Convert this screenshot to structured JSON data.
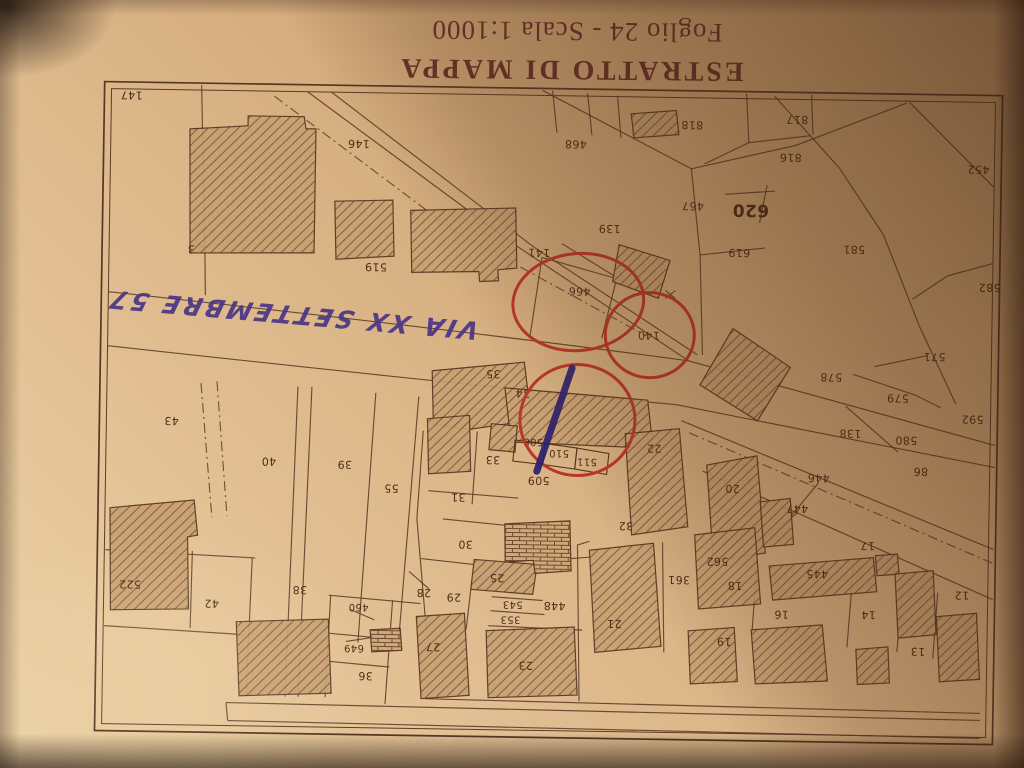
{
  "document": {
    "title": "ESTRATTO DI MAPPA",
    "subtitle": "Foglio 24 - Scala 1:1000",
    "orientation": "photo rotated 180 degrees"
  },
  "map": {
    "street_label": "VIA XX SETTEMBRE 57",
    "colors": {
      "paper": "#ddb98c",
      "ink": "#5a3b26",
      "title_ink": "#69302a",
      "red_pen": "#bc3628",
      "blue_pen": "#2b1f6e",
      "violet_pen": "#4a3585"
    },
    "parcel_labels": [
      {
        "n": "147",
        "x": 127,
        "y": 101
      },
      {
        "n": "146",
        "x": 355,
        "y": 146
      },
      {
        "n": "3",
        "x": 189,
        "y": 254
      },
      {
        "n": "519",
        "x": 374,
        "y": 269
      },
      {
        "n": "141",
        "x": 537,
        "y": 252
      },
      {
        "n": "466",
        "x": 578,
        "y": 290
      },
      {
        "n": "139",
        "x": 607,
        "y": 227
      },
      {
        "n": "140",
        "x": 648,
        "y": 333
      },
      {
        "n": "468",
        "x": 572,
        "y": 143
      },
      {
        "n": "467",
        "x": 690,
        "y": 203
      },
      {
        "n": "818",
        "x": 688,
        "y": 122
      },
      {
        "n": "817",
        "x": 793,
        "y": 115
      },
      {
        "n": "816",
        "x": 787,
        "y": 153
      },
      {
        "n": "620",
        "x": 748,
        "y": 206,
        "s": 17,
        "b": 1
      },
      {
        "n": "619",
        "x": 737,
        "y": 249
      },
      {
        "n": "581",
        "x": 852,
        "y": 244
      },
      {
        "n": "452",
        "x": 975,
        "y": 162
      },
      {
        "n": "582",
        "x": 988,
        "y": 280
      },
      {
        "n": "571",
        "x": 934,
        "y": 350
      },
      {
        "n": "578",
        "x": 831,
        "y": 372
      },
      {
        "n": "579",
        "x": 898,
        "y": 392
      },
      {
        "n": "592",
        "x": 973,
        "y": 412
      },
      {
        "n": "138",
        "x": 851,
        "y": 428
      },
      {
        "n": "580",
        "x": 907,
        "y": 434
      },
      {
        "n": "86",
        "x": 922,
        "y": 465
      },
      {
        "n": "43",
        "x": 172,
        "y": 426
      },
      {
        "n": "40",
        "x": 270,
        "y": 465
      },
      {
        "n": "39",
        "x": 346,
        "y": 467
      },
      {
        "n": "55",
        "x": 393,
        "y": 490
      },
      {
        "n": "35",
        "x": 493,
        "y": 374
      },
      {
        "n": "34",
        "x": 523,
        "y": 393
      },
      {
        "n": "508",
        "x": 534,
        "y": 441,
        "s": 10
      },
      {
        "n": "510",
        "x": 560,
        "y": 452,
        "s": 10
      },
      {
        "n": "511",
        "x": 588,
        "y": 460,
        "s": 10
      },
      {
        "n": "509",
        "x": 540,
        "y": 480
      },
      {
        "n": "33",
        "x": 494,
        "y": 460
      },
      {
        "n": "31",
        "x": 460,
        "y": 498
      },
      {
        "n": "22",
        "x": 655,
        "y": 446
      },
      {
        "n": "20",
        "x": 734,
        "y": 485
      },
      {
        "n": "446",
        "x": 820,
        "y": 473
      },
      {
        "n": "447",
        "x": 799,
        "y": 504
      },
      {
        "n": "30",
        "x": 468,
        "y": 545
      },
      {
        "n": "32",
        "x": 628,
        "y": 524
      },
      {
        "n": "29",
        "x": 457,
        "y": 598
      },
      {
        "n": "28",
        "x": 427,
        "y": 594
      },
      {
        "n": "25",
        "x": 500,
        "y": 578
      },
      {
        "n": "543",
        "x": 516,
        "y": 604,
        "s": 10
      },
      {
        "n": "353",
        "x": 514,
        "y": 619,
        "s": 10
      },
      {
        "n": "448",
        "x": 558,
        "y": 605
      },
      {
        "n": "21",
        "x": 618,
        "y": 622
      },
      {
        "n": "23",
        "x": 530,
        "y": 665
      },
      {
        "n": "27",
        "x": 437,
        "y": 648
      },
      {
        "n": "36",
        "x": 370,
        "y": 678
      },
      {
        "n": "649",
        "x": 358,
        "y": 650,
        "s": 10
      },
      {
        "n": "460",
        "x": 362,
        "y": 609,
        "s": 10
      },
      {
        "n": "38",
        "x": 303,
        "y": 593
      },
      {
        "n": "42",
        "x": 215,
        "y": 608
      },
      {
        "n": "522",
        "x": 133,
        "y": 590
      },
      {
        "n": "562",
        "x": 720,
        "y": 558
      },
      {
        "n": "361",
        "x": 682,
        "y": 577
      },
      {
        "n": "18",
        "x": 738,
        "y": 582
      },
      {
        "n": "19",
        "x": 728,
        "y": 638
      },
      {
        "n": "16",
        "x": 785,
        "y": 610
      },
      {
        "n": "445",
        "x": 820,
        "y": 569
      },
      {
        "n": "17",
        "x": 870,
        "y": 540
      },
      {
        "n": "14",
        "x": 872,
        "y": 609
      },
      {
        "n": "13",
        "x": 922,
        "y": 645
      },
      {
        "n": "12",
        "x": 965,
        "y": 588
      }
    ],
    "annotations": {
      "circles": [
        {
          "cx": 577,
          "cy": 301,
          "rx": 64,
          "ry": 47,
          "rot": -6,
          "around": "466"
        },
        {
          "cx": 649,
          "cy": 333,
          "rx": 43,
          "ry": 41,
          "rot": 0,
          "around": "140"
        },
        {
          "cx": 578,
          "cy": 419,
          "rx": 56,
          "ry": 54,
          "rot": 0,
          "around": "508 510 511"
        }
      ],
      "pen_stroke": {
        "cx": 555,
        "cy": 419,
        "len": 116,
        "w": 7,
        "angle": 18
      }
    }
  }
}
